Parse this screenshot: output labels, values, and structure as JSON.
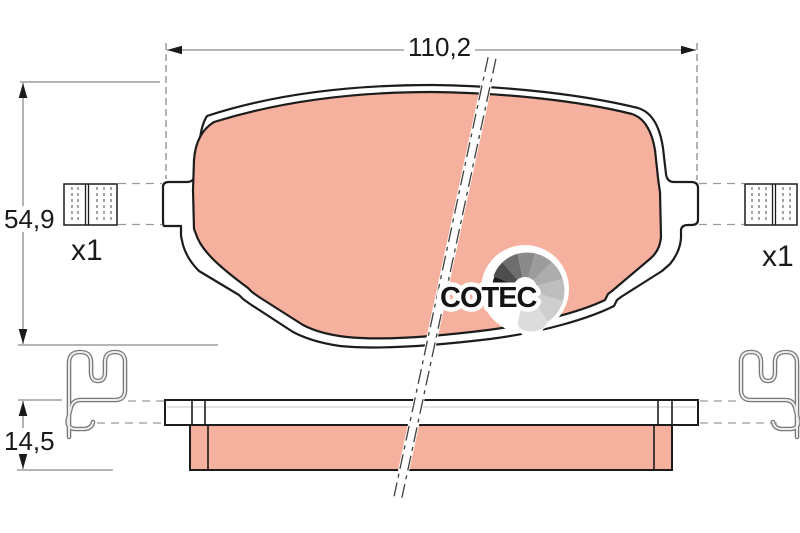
{
  "drawing": {
    "dim_width": "110,2",
    "dim_height": "54,9",
    "dim_thickness": "14,5",
    "qty_left": "x1",
    "qty_right": "x1"
  },
  "logo": {
    "text": "COTEC"
  },
  "colors": {
    "pad_fill": "#f5b19d",
    "pad_outline": "#1c1c1c",
    "dim_gray": "#8a8a8a",
    "clip_gray": "#7a7a7a",
    "clip_light": "#ececec",
    "logo_black": "#141414"
  }
}
